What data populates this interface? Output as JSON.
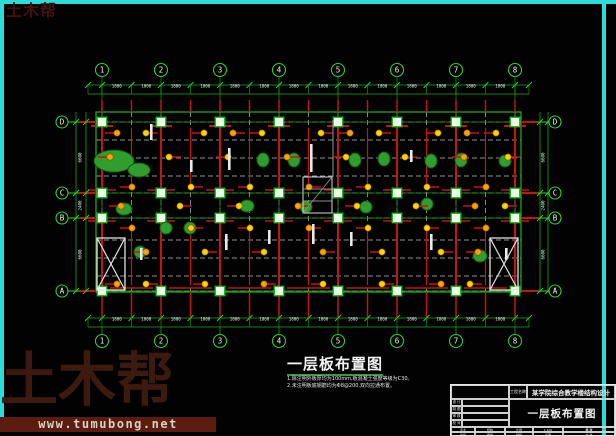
{
  "logo_small": "土木帮",
  "watermark": {
    "brand": "土木帮",
    "url": "www.tumubong.net"
  },
  "drawing_title": {
    "text": "一层板布置图",
    "notes": [
      "1.除注明外板厚均为100mm,板混凝土强度等级为C30。",
      "2.未注明板底钢筋均为Φ8@200,双向拉通布置。"
    ]
  },
  "titleblock": {
    "project_label": "工程名称",
    "project_name": "某学院综合教学楼结构设计",
    "rows": [
      "设 计",
      "制 图",
      "审 核",
      "校 对"
    ],
    "drawing_name": "一层板布置图",
    "bottom1": [
      "专业",
      "结构",
      "比例",
      "1:100",
      "第 张"
    ],
    "bottom2": [
      "班级",
      "图号",
      "结施",
      "日期",
      "共 张"
    ]
  },
  "plan": {
    "colors": {
      "green": "#2fd32f",
      "dimgreen": "#1aa81a",
      "red": "#c41414",
      "yellow": "#ffd200",
      "orange": "#ffa000",
      "white": "#e9e9e9",
      "dash": "#c0c0c0",
      "colfill": "#eaffea",
      "cyan": "#2bdcd8",
      "blob": "#2f9e2f",
      "bubbletext": "#e6ffe6"
    },
    "axes_x": [
      {
        "label": "1",
        "x": 102
      },
      {
        "label": "2",
        "x": 161
      },
      {
        "label": "3",
        "x": 220
      },
      {
        "label": "4",
        "x": 279
      },
      {
        "label": "5",
        "x": 338
      },
      {
        "label": "6",
        "x": 397
      },
      {
        "label": "7",
        "x": 456
      },
      {
        "label": "8",
        "x": 515
      }
    ],
    "axes_y": [
      {
        "label": "D",
        "y": 122
      },
      {
        "label": "C",
        "y": 193
      },
      {
        "label": "B",
        "y": 218
      },
      {
        "label": "A",
        "y": 291
      }
    ],
    "building": {
      "l": 96,
      "r": 521,
      "t": 112,
      "b": 292
    },
    "dims": {
      "half_bay": "1800",
      "left_bays": [
        "6600",
        "2400",
        "6600"
      ]
    },
    "dash_h": [
      122,
      140,
      158,
      176,
      193,
      218,
      240,
      258,
      276,
      291
    ],
    "dot_rows": [
      [
        133,
        [
          117,
          146,
          204,
          233,
          262,
          321,
          350,
          379,
          438,
          467,
          496
        ]
      ],
      [
        157,
        [
          110,
          169,
          228,
          287,
          346,
          405,
          464,
          508
        ]
      ],
      [
        187,
        [
          132,
          191,
          250,
          309,
          368,
          427,
          486
        ]
      ],
      [
        206,
        [
          121,
          180,
          239,
          298,
          357,
          416,
          475,
          505
        ]
      ],
      [
        228,
        [
          132,
          191,
          250,
          309,
          368,
          427,
          486
        ]
      ],
      [
        252,
        [
          146,
          205,
          264,
          323,
          382,
          441,
          478
        ]
      ],
      [
        284,
        [
          117,
          146,
          205,
          264,
          323,
          382,
          441,
          470
        ]
      ]
    ],
    "blobs": [
      [
        114,
        161,
        20,
        11
      ],
      [
        139,
        170,
        11,
        7
      ],
      [
        263,
        160,
        6,
        7
      ],
      [
        294,
        160,
        6,
        7
      ],
      [
        355,
        160,
        6,
        7
      ],
      [
        384,
        159,
        6,
        7
      ],
      [
        431,
        161,
        6,
        7
      ],
      [
        461,
        160,
        6,
        7
      ],
      [
        505,
        161,
        6,
        6
      ],
      [
        124,
        209,
        8,
        6
      ],
      [
        166,
        228,
        6,
        6
      ],
      [
        190,
        228,
        6,
        6
      ],
      [
        247,
        206,
        7,
        6
      ],
      [
        306,
        207,
        6,
        6
      ],
      [
        366,
        207,
        6,
        6
      ],
      [
        427,
        204,
        6,
        6
      ],
      [
        480,
        256,
        7,
        6
      ],
      [
        140,
        252,
        6,
        6
      ]
    ],
    "labels_v": [
      [
        150,
        124,
        16
      ],
      [
        228,
        148,
        22
      ],
      [
        310,
        144,
        28
      ],
      [
        190,
        160,
        12
      ],
      [
        410,
        150,
        12
      ],
      [
        268,
        230,
        14
      ],
      [
        225,
        234,
        16
      ],
      [
        312,
        224,
        20
      ],
      [
        350,
        232,
        14
      ],
      [
        430,
        234,
        16
      ],
      [
        505,
        248,
        12
      ],
      [
        140,
        248,
        12
      ]
    ],
    "stairs": [
      [
        97,
        238,
        28,
        52
      ],
      [
        490,
        238,
        28,
        52
      ]
    ],
    "midstair": {
      "x": 303,
      "y": 177,
      "w": 29,
      "h": 36
    }
  }
}
